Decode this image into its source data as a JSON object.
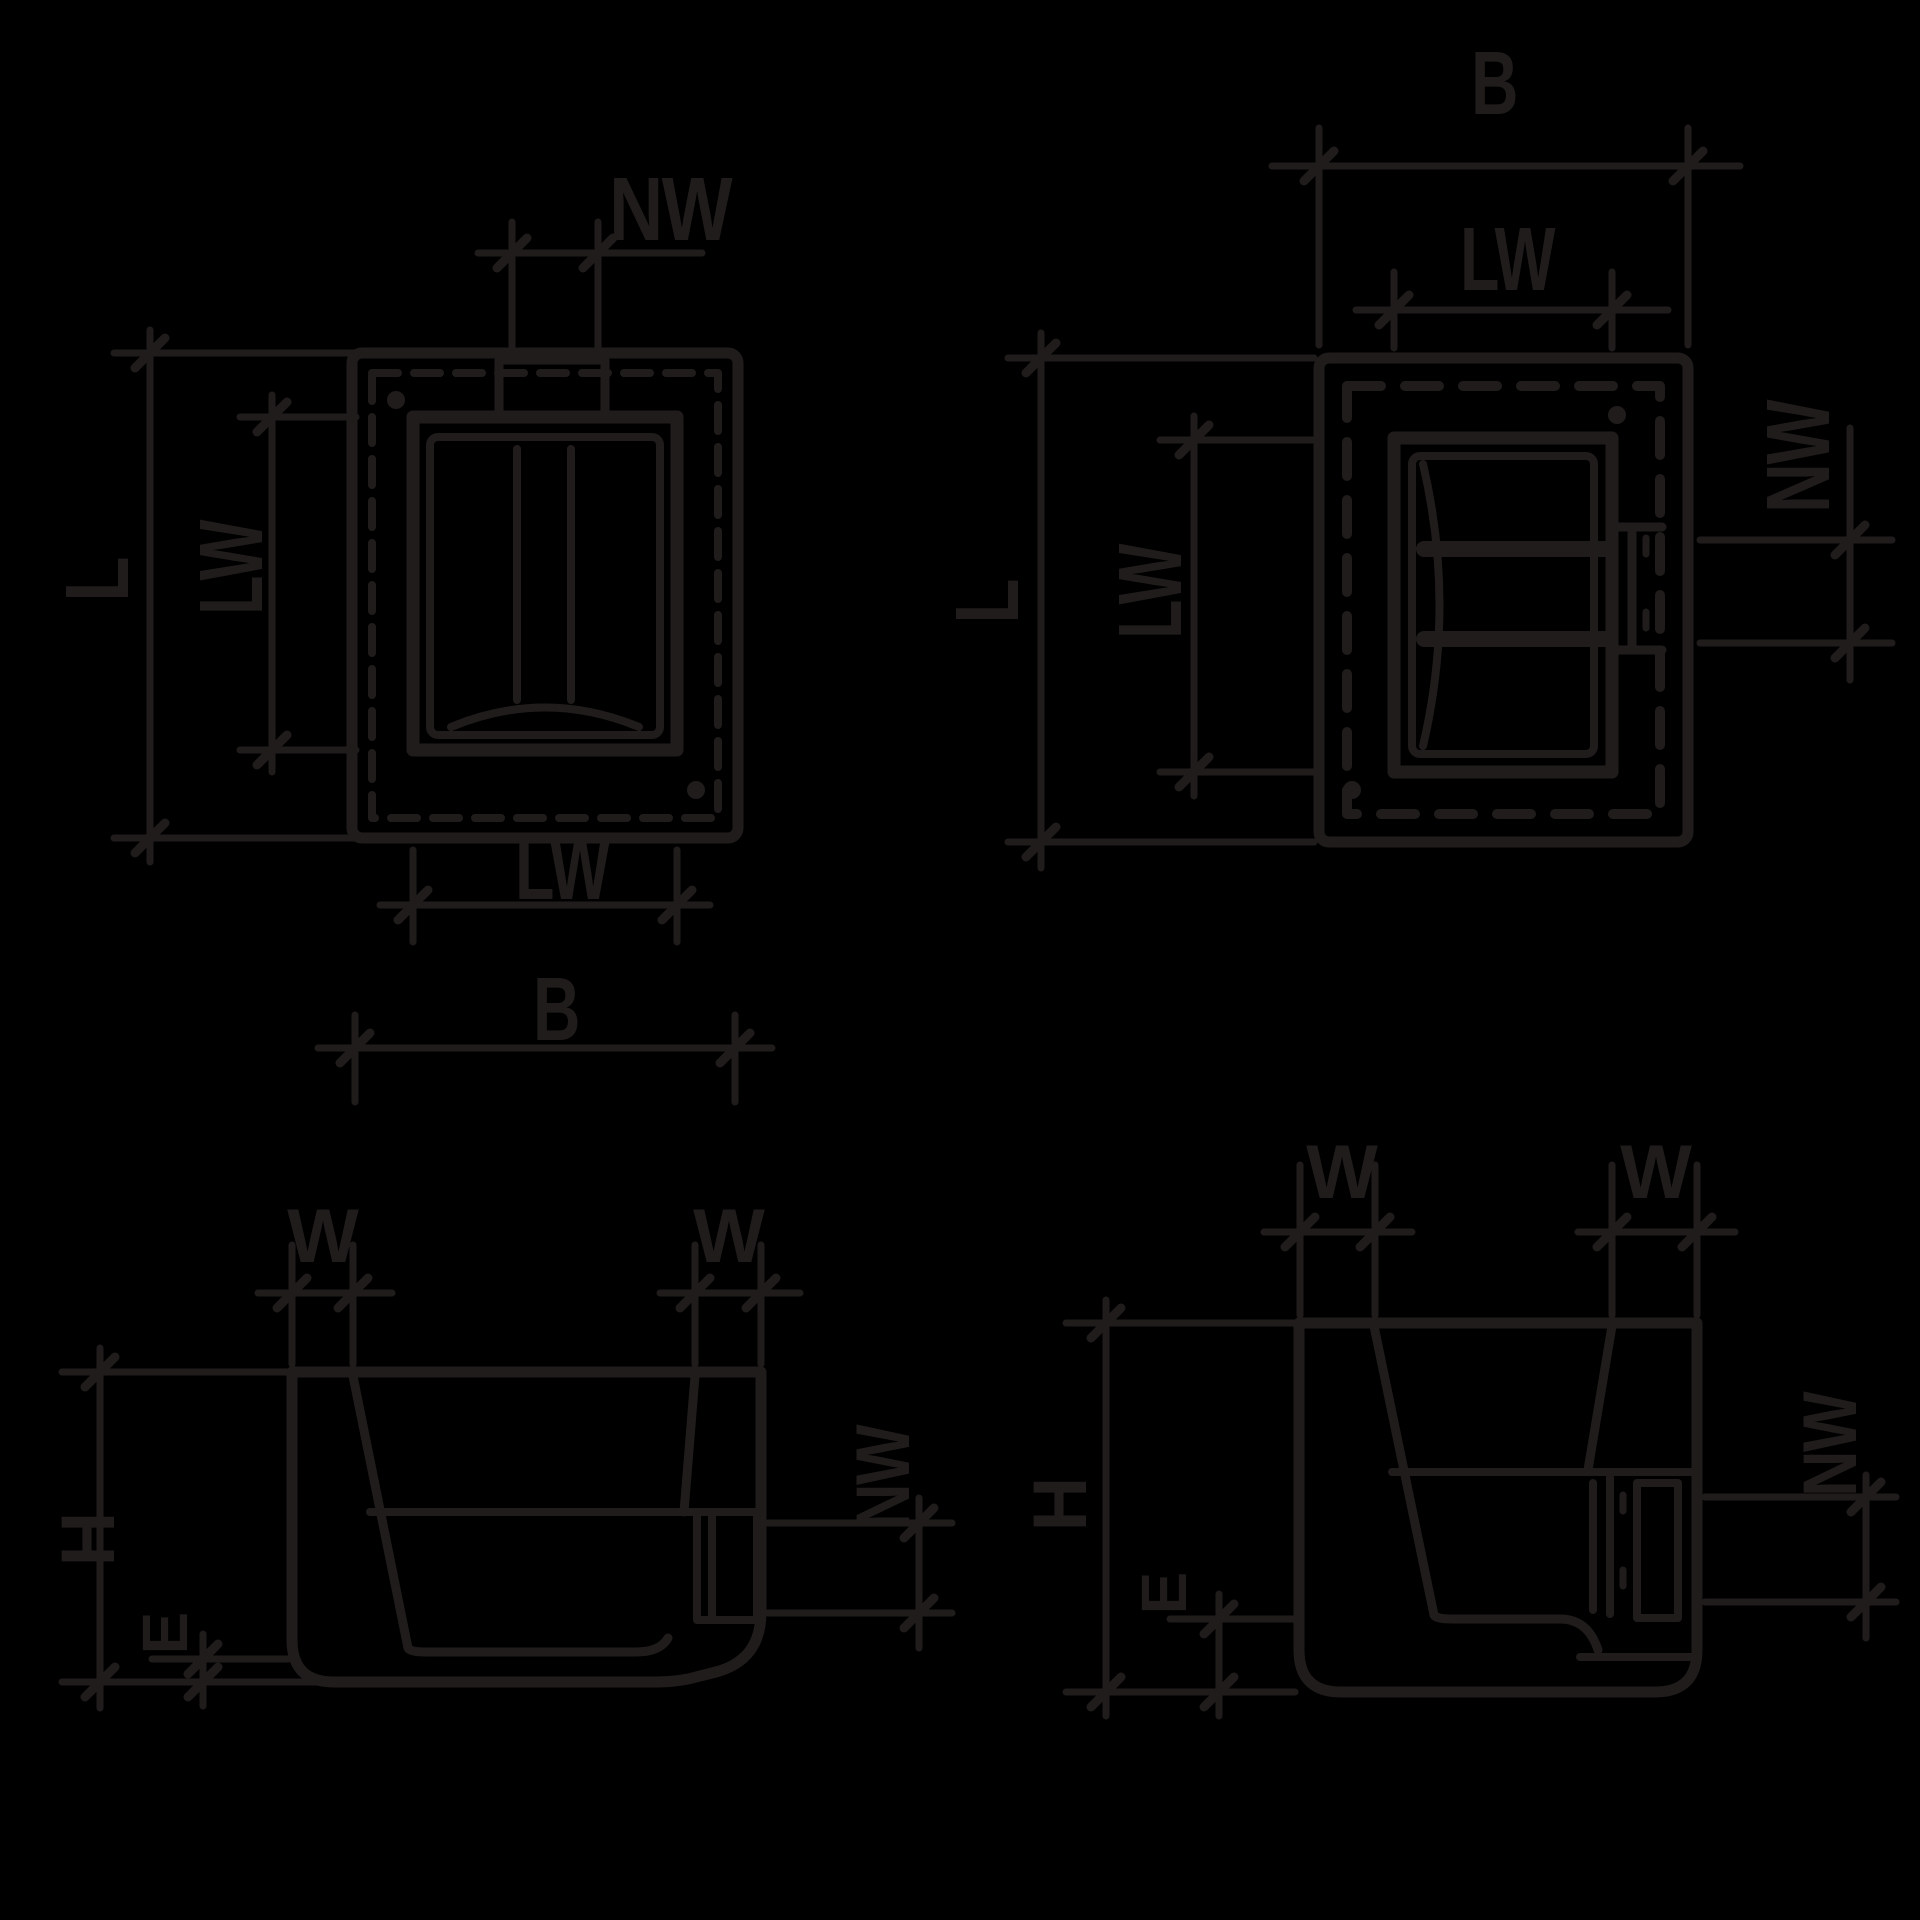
{
  "canvas": {
    "background": "#000000",
    "line_color": "#201c1b"
  },
  "diagrams": {
    "plan_top_left": {
      "labels": {
        "nw": "NW",
        "l": "L",
        "lw_side": "LW",
        "lw_bottom": "LW",
        "b": "B"
      }
    },
    "plan_top_right": {
      "labels": {
        "b": "B",
        "lw_top": "LW",
        "l": "L",
        "lw_side": "LW",
        "nw": "NW"
      }
    },
    "section_bottom_left": {
      "labels": {
        "w_left": "W",
        "w_right": "W",
        "h": "H",
        "e": "E",
        "nw": "NW"
      }
    },
    "section_bottom_right": {
      "labels": {
        "w_left": "W",
        "w_right": "W",
        "h": "H",
        "e": "E",
        "nw": "NW"
      }
    }
  }
}
